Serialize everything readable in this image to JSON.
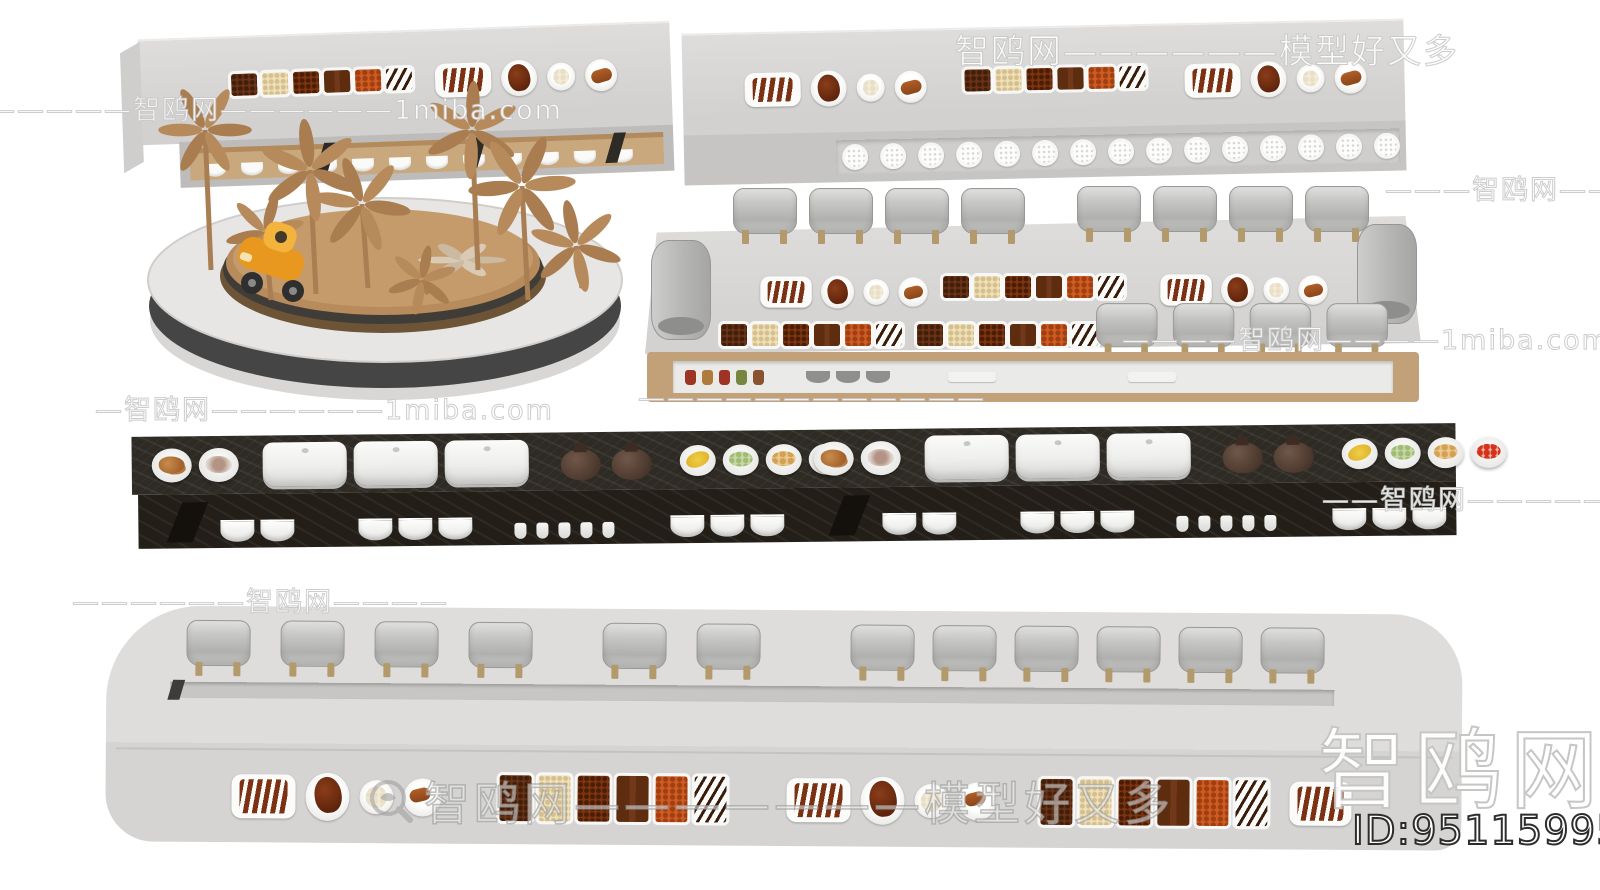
{
  "page": {
    "width": 1600,
    "height": 890,
    "background": "#ffffff",
    "kind": "3d-model-preview-render"
  },
  "watermarks": {
    "top_left": "—————智鸥网——————1miba.com",
    "top_right": "智鸥网——————模型好又多",
    "right_upper": "———智鸥网———",
    "mid_right": "————智鸥网————1miba.com",
    "mid_dashes": "————————————",
    "mid_left": "—智鸥网——————1miba.com",
    "right_lower": "——智鸥网——————",
    "left_lower": "——————智鸥网————",
    "bottom_center": "智鸥网———————模型好又多",
    "brand_large": "智鸥网",
    "model_id": "ID:951159952"
  },
  "scene": {
    "top_left_counter": {
      "label": "dessert-buffet-counter",
      "chocolate_trays": 6,
      "shelf_bowls": 12
    },
    "top_right_counter": {
      "label": "dessert-buffet-counter-long",
      "chocolate_trays": 6,
      "shelf_plates": 15
    },
    "windmill_platform": {
      "label": "round-windmill-sculpture-platform",
      "windmills": 8,
      "has_toy_vehicle": true
    },
    "urn_counter": {
      "label": "buffet-counter-with-soup-urns",
      "back_urns_left": 4,
      "back_urns_right": 4,
      "front_urns": 4,
      "end_barrels": 2,
      "upper_chocolate_trays": 6,
      "lower_chocolate_trays_a": 6,
      "lower_chocolate_trays_b": 6,
      "shelf_jars": 5
    },
    "dark_counter": {
      "label": "dark-marble-buffet-counter",
      "modules": 2,
      "module_items": [
        "croissant-plate",
        "cocoa-bowl",
        "chafing-cloche",
        "chafing-cloche",
        "chafing-cloche",
        "teapot",
        "teapot",
        "banana-bowl",
        "grape-bowl",
        "meatball-bowl",
        "berry-bowl"
      ]
    },
    "bottom_counter": {
      "label": "rounded-buffet-counter",
      "urns": 12,
      "chocolate_trays_a": 6,
      "chocolate_trays_b": 6
    },
    "dish_set": [
      "ribs-tray",
      "roast-duck-plate",
      "dumpling-plate",
      "bread-plate"
    ]
  },
  "colors": {
    "counter_light": "#d8d7d5",
    "counter_front": "#c6c5c3",
    "wood_shelf": "#c9a87e",
    "dark_marble": "#2e2a24",
    "urn_grey": "#c2c2c0",
    "chocolate": "#5f2d11",
    "toy_orange": "#e8981e",
    "windmill_wood": "#b78a5b"
  }
}
